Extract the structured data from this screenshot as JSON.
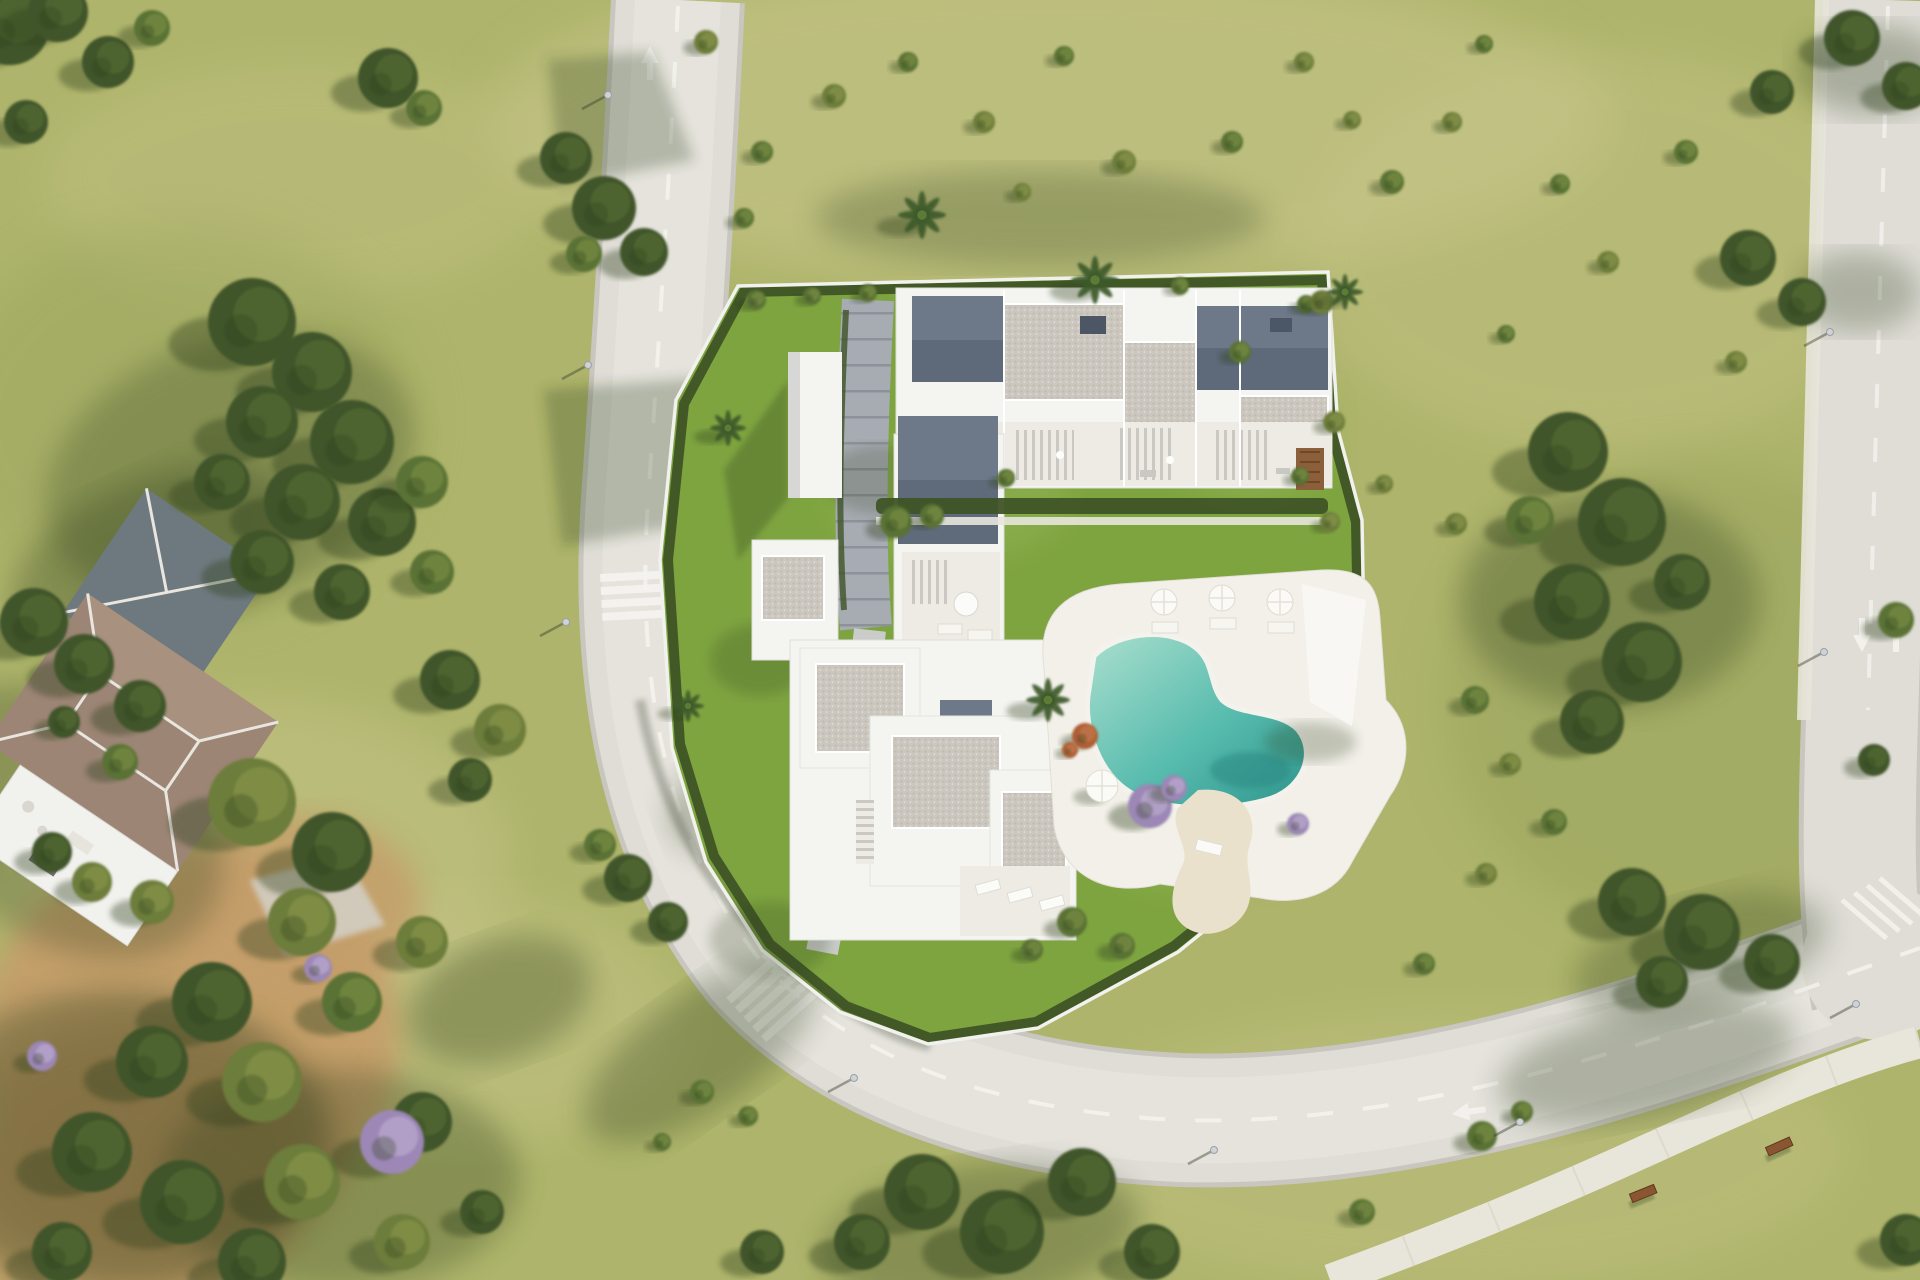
{
  "meta": {
    "title": "Aerial 3D render of a modern residential complex with pool, surrounding roads and landscaped grounds",
    "width": 1920,
    "height": 1280,
    "tree_entry_format": "[x, y, radius, tone] tone: d=dark green, m=mid green, o=olive, p=purple-flowering, r=rust-orange",
    "palm_entry_format": "[x, y, radius]",
    "lamp_entry_format": "[x, y]",
    "bench_entry_format": "[x, y, rotation_deg]",
    "shade_entry_format": "soft cast-shadow blobs {x,y,rx,ry,rot,o}"
  },
  "palette": {
    "grass": "#aeb46b",
    "grassLight": "#c9c78c",
    "grassDark": "#8d9a54",
    "lawn": "#7ea440",
    "lawnLight": "#95b757",
    "road": "#dfddd6",
    "roadEdge": "#c8c6be",
    "roadBright": "#e9e7e1",
    "roadLine": "#f4f3ef",
    "pavement": "#a7abb2",
    "pavementJoint": "#8d929a",
    "walkway": "#c9ccc9",
    "sidewalk": "#e8e5da",
    "wall": "#f1f1ee",
    "hedge": "#3f5426",
    "shadow": "#2e401f",
    "building": "#f4f4f1",
    "buildingShade": "#d7d8d6",
    "roofSlate": "#6d7889",
    "roofSlateDark": "#525d6c",
    "roofGray": "#b7bcc3",
    "gravel": "#cbc7be",
    "gravelDark": "#b2aea5",
    "terrace": "#edebe4",
    "slat": "#c9c8c2",
    "wood": "#8b5f3a",
    "poolDeck": "#f2f0e9",
    "water1": "#abdfce",
    "water2": "#58bcae",
    "water3": "#2f958d",
    "sand": "#eae1cd",
    "dirt": "#c59e6b",
    "dirtDark": "#a87f4e",
    "villaRoof": "#9c8575",
    "villaRoofLight": "#b39a85",
    "villaSlate": "#6e797f",
    "bench": "#8a5631",
    "treeDark": "#41552a",
    "treeMid": "#5a7235",
    "treeOlive": "#6d7d3a",
    "treeLight": "#7f9447",
    "purple": "#9c87b6",
    "purpleLight": "#c3b3d6",
    "rust": "#ad5f36",
    "lamp": "#cfd2d6"
  },
  "scene": {
    "trees": [
      [
        10,
        25,
        40,
        "d"
      ],
      [
        58,
        12,
        30,
        "d"
      ],
      [
        108,
        62,
        26,
        "d"
      ],
      [
        26,
        122,
        22,
        "d"
      ],
      [
        152,
        28,
        18,
        "m"
      ],
      [
        388,
        78,
        30,
        "d"
      ],
      [
        424,
        108,
        18,
        "m"
      ],
      [
        566,
        158,
        26,
        "d"
      ],
      [
        604,
        208,
        32,
        "d"
      ],
      [
        644,
        252,
        24,
        "d"
      ],
      [
        584,
        254,
        18,
        "m"
      ],
      [
        706,
        42,
        12,
        "o"
      ],
      [
        762,
        152,
        11,
        "m"
      ],
      [
        834,
        96,
        12,
        "o"
      ],
      [
        908,
        62,
        10,
        "m"
      ],
      [
        984,
        122,
        11,
        "o"
      ],
      [
        1064,
        56,
        10,
        "m"
      ],
      [
        1124,
        162,
        12,
        "o"
      ],
      [
        1232,
        142,
        11,
        "m"
      ],
      [
        1304,
        62,
        10,
        "o"
      ],
      [
        1392,
        182,
        12,
        "m"
      ],
      [
        1452,
        122,
        10,
        "o"
      ],
      [
        1484,
        44,
        9,
        "m"
      ],
      [
        744,
        218,
        10,
        "m"
      ],
      [
        1022,
        192,
        9,
        "o"
      ],
      [
        1352,
        120,
        9,
        "o"
      ],
      [
        1560,
        184,
        10,
        "m"
      ],
      [
        1608,
        262,
        11,
        "o"
      ],
      [
        1686,
        152,
        12,
        "m"
      ],
      [
        1736,
        362,
        11,
        "o"
      ],
      [
        1506,
        334,
        9,
        "m"
      ],
      [
        1456,
        524,
        11,
        "o"
      ],
      [
        1306,
        304,
        9,
        "m"
      ],
      [
        1384,
        484,
        9,
        "o"
      ],
      [
        1554,
        822,
        13,
        "m"
      ],
      [
        1486,
        874,
        11,
        "o"
      ],
      [
        1424,
        964,
        11,
        "m"
      ],
      [
        1475,
        700,
        14,
        "m"
      ],
      [
        1510,
        764,
        11,
        "o"
      ],
      [
        252,
        322,
        44,
        "d"
      ],
      [
        312,
        372,
        40,
        "d"
      ],
      [
        262,
        422,
        36,
        "d"
      ],
      [
        352,
        442,
        42,
        "d"
      ],
      [
        302,
        502,
        38,
        "d"
      ],
      [
        382,
        522,
        34,
        "d"
      ],
      [
        262,
        562,
        32,
        "d"
      ],
      [
        342,
        592,
        28,
        "d"
      ],
      [
        422,
        482,
        26,
        "m"
      ],
      [
        432,
        572,
        22,
        "m"
      ],
      [
        222,
        482,
        28,
        "d"
      ],
      [
        450,
        680,
        30,
        "d"
      ],
      [
        500,
        730,
        26,
        "o"
      ],
      [
        470,
        780,
        22,
        "d"
      ],
      [
        120,
        762,
        18,
        "m"
      ],
      [
        64,
        722,
        16,
        "d"
      ],
      [
        92,
        882,
        20,
        "o"
      ],
      [
        628,
        878,
        24,
        "d"
      ],
      [
        668,
        922,
        20,
        "d"
      ],
      [
        600,
        845,
        16,
        "m"
      ],
      [
        702,
        1092,
        12,
        "m"
      ],
      [
        748,
        1116,
        10,
        "m"
      ],
      [
        662,
        1142,
        9,
        "m"
      ],
      [
        34,
        622,
        34,
        "d"
      ],
      [
        84,
        664,
        30,
        "d"
      ],
      [
        140,
        706,
        26,
        "d"
      ],
      [
        252,
        802,
        44,
        "o"
      ],
      [
        332,
        852,
        40,
        "d"
      ],
      [
        302,
        922,
        34,
        "o"
      ],
      [
        212,
        1002,
        40,
        "d"
      ],
      [
        152,
        1062,
        36,
        "d"
      ],
      [
        262,
        1082,
        40,
        "o"
      ],
      [
        352,
        1002,
        30,
        "m"
      ],
      [
        422,
        942,
        26,
        "o"
      ],
      [
        92,
        1152,
        40,
        "d"
      ],
      [
        182,
        1202,
        42,
        "d"
      ],
      [
        302,
        1182,
        38,
        "o"
      ],
      [
        422,
        1122,
        30,
        "d"
      ],
      [
        62,
        1252,
        30,
        "d"
      ],
      [
        252,
        1262,
        34,
        "d"
      ],
      [
        402,
        1242,
        28,
        "o"
      ],
      [
        482,
        1212,
        22,
        "d"
      ],
      [
        152,
        902,
        22,
        "o"
      ],
      [
        52,
        852,
        20,
        "d"
      ],
      [
        392,
        1142,
        32,
        "p"
      ],
      [
        42,
        1056,
        15,
        "p"
      ],
      [
        318,
        968,
        14,
        "p"
      ],
      [
        1568,
        452,
        40,
        "d"
      ],
      [
        1622,
        522,
        44,
        "d"
      ],
      [
        1572,
        602,
        38,
        "d"
      ],
      [
        1642,
        662,
        40,
        "d"
      ],
      [
        1592,
        722,
        32,
        "d"
      ],
      [
        1682,
        582,
        28,
        "d"
      ],
      [
        1530,
        520,
        24,
        "m"
      ],
      [
        1748,
        258,
        28,
        "d"
      ],
      [
        1802,
        302,
        24,
        "d"
      ],
      [
        1772,
        92,
        22,
        "d"
      ],
      [
        1852,
        38,
        28,
        "d"
      ],
      [
        1906,
        86,
        24,
        "d"
      ],
      [
        1896,
        620,
        18,
        "m"
      ],
      [
        1874,
        760,
        16,
        "d"
      ],
      [
        1632,
        902,
        34,
        "d"
      ],
      [
        1702,
        932,
        38,
        "d"
      ],
      [
        1772,
        962,
        28,
        "d"
      ],
      [
        1662,
        982,
        26,
        "d"
      ],
      [
        922,
        1192,
        38,
        "d"
      ],
      [
        1002,
        1232,
        42,
        "d"
      ],
      [
        1082,
        1182,
        34,
        "d"
      ],
      [
        862,
        1242,
        28,
        "d"
      ],
      [
        1152,
        1252,
        28,
        "d"
      ],
      [
        762,
        1252,
        22,
        "d"
      ],
      [
        1482,
        1136,
        15,
        "m"
      ],
      [
        1522,
        1112,
        11,
        "m"
      ],
      [
        1362,
        1212,
        13,
        "m"
      ],
      [
        1906,
        1240,
        26,
        "d"
      ],
      [
        896,
        522,
        16,
        "m"
      ],
      [
        932,
        516,
        12,
        "m"
      ],
      [
        1006,
        478,
        9,
        "m"
      ],
      [
        1240,
        352,
        11,
        "m"
      ],
      [
        1322,
        302,
        12,
        "o"
      ],
      [
        1334,
        422,
        11,
        "o"
      ],
      [
        1330,
        522,
        10,
        "o"
      ],
      [
        1300,
        476,
        9,
        "m"
      ],
      [
        1085,
        736,
        13,
        "r"
      ],
      [
        1070,
        750,
        8,
        "r"
      ],
      [
        1150,
        806,
        22,
        "p"
      ],
      [
        1174,
        788,
        13,
        "p"
      ],
      [
        1298,
        824,
        11,
        "p"
      ],
      [
        1072,
        922,
        15,
        "m"
      ],
      [
        1122,
        946,
        13,
        "m"
      ],
      [
        1032,
        950,
        11,
        "m"
      ],
      [
        756,
        300,
        10,
        "m"
      ],
      [
        812,
        296,
        9,
        "m"
      ],
      [
        868,
        293,
        9,
        "m"
      ],
      [
        1180,
        286,
        9,
        "m"
      ]
    ],
    "palms": [
      [
        922,
        215,
        24
      ],
      [
        1095,
        280,
        24
      ],
      [
        1345,
        292,
        18
      ],
      [
        1048,
        700,
        22
      ],
      [
        728,
        428,
        18
      ],
      [
        688,
        706,
        16
      ]
    ],
    "lamps": [
      [
        608,
        95
      ],
      [
        588,
        365
      ],
      [
        566,
        622
      ],
      [
        854,
        1078
      ],
      [
        1214,
        1150
      ],
      [
        1520,
        1122
      ],
      [
        1830,
        332
      ],
      [
        1824,
        652
      ],
      [
        1856,
        1004
      ]
    ],
    "benches": [
      [
        1643,
        1193,
        -22
      ],
      [
        1779,
        1146,
        -24
      ]
    ],
    "shades": [
      {
        "x": 150,
        "y": 560,
        "rx": 150,
        "ry": 80,
        "rot": -25,
        "o": 0.3
      },
      {
        "x": 120,
        "y": 1140,
        "rx": 210,
        "ry": 150,
        "rot": 0,
        "o": 0.35
      },
      {
        "x": 500,
        "y": 1000,
        "rx": 95,
        "ry": 60,
        "rot": -20,
        "o": 0.3
      },
      {
        "x": 980,
        "y": 1235,
        "rx": 160,
        "ry": 70,
        "rot": -8,
        "o": 0.3
      },
      {
        "x": 1700,
        "y": 955,
        "rx": 130,
        "ry": 55,
        "rot": -15,
        "o": 0.28
      },
      {
        "x": 230,
        "y": 470,
        "rx": 190,
        "ry": 130,
        "rot": -20,
        "o": 0.28
      },
      {
        "x": 1610,
        "y": 600,
        "rx": 150,
        "ry": 110,
        "rot": 0,
        "o": 0.3
      },
      {
        "x": 340,
        "y": 1180,
        "rx": 180,
        "ry": 110,
        "rot": 0,
        "o": 0.3
      },
      {
        "x": 1040,
        "y": 218,
        "rx": 225,
        "ry": 48,
        "rot": 0,
        "o": 0.26
      },
      {
        "x": 700,
        "y": 1052,
        "rx": 135,
        "ry": 58,
        "rot": -35,
        "o": 0.3
      },
      {
        "x": 1646,
        "y": 1062,
        "rx": 150,
        "ry": 55,
        "rot": -12,
        "o": 0.3
      },
      {
        "x": 1872,
        "y": 70,
        "rx": 75,
        "ry": 45,
        "rot": 0,
        "o": 0.3
      },
      {
        "x": 1858,
        "y": 292,
        "rx": 62,
        "ry": 40,
        "rot": 0,
        "o": 0.28
      },
      {
        "x": 745,
        "y": 800,
        "rx": 80,
        "ry": 50,
        "rot": -20,
        "o": 0.28
      }
    ]
  }
}
